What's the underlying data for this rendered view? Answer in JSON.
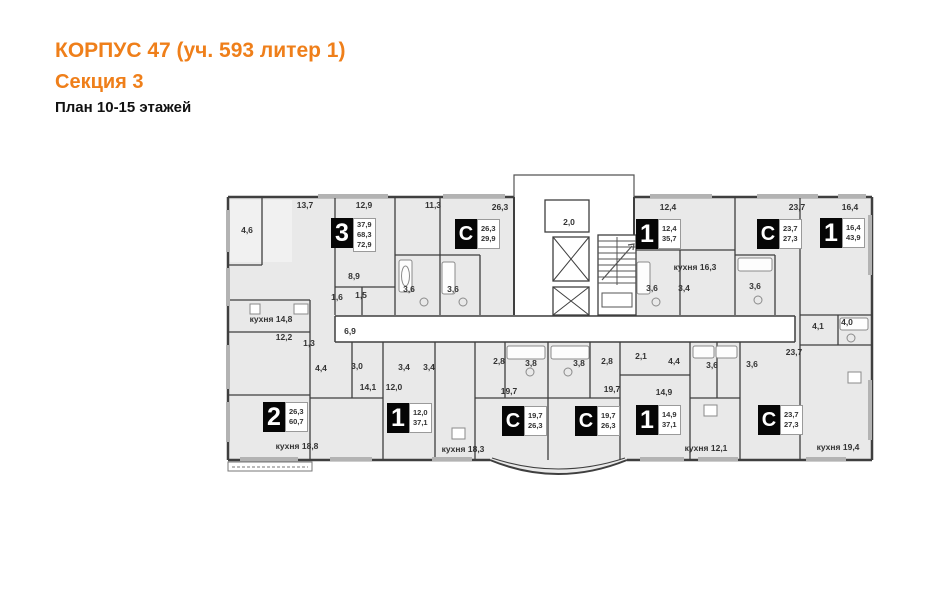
{
  "header": {
    "title": "КОРПУС 47 (уч. 593 литер 1)",
    "subtitle": "Секция 3",
    "plan_label": "План 10-15 этажей"
  },
  "colors": {
    "accent": "#EF7F1A",
    "wall": "#3f3f3f",
    "room_fill": "#e9e9e9"
  },
  "apartments": [
    {
      "type": "3",
      "areas": [
        "37,9",
        "68,3",
        "72,9"
      ]
    },
    {
      "type": "С",
      "areas": [
        "26,3",
        "29,9"
      ]
    },
    {
      "type": "1",
      "areas": [
        "12,4",
        "35,7"
      ]
    },
    {
      "type": "С",
      "areas": [
        "23,7",
        "27,3"
      ]
    },
    {
      "type": "1",
      "areas": [
        "16,4",
        "43,9"
      ]
    },
    {
      "type": "2",
      "areas": [
        "26,3",
        "60,7"
      ]
    },
    {
      "type": "1",
      "areas": [
        "12,0",
        "37,1"
      ]
    },
    {
      "type": "С",
      "areas": [
        "19,7",
        "26,3"
      ]
    },
    {
      "type": "С",
      "areas": [
        "19,7",
        "26,3"
      ]
    },
    {
      "type": "1",
      "areas": [
        "14,9",
        "37,1"
      ]
    },
    {
      "type": "С",
      "areas": [
        "23,7",
        "27,3"
      ]
    }
  ],
  "labels": [
    "4,6",
    "13,7",
    "12,9",
    "11,3",
    "26,3",
    "2,0",
    "12,4",
    "23,7",
    "16,4",
    "кухня 16,3",
    "8,9",
    "1,6",
    "1,5",
    "3,6",
    "3,6",
    "3,6",
    "3,4",
    "3,6",
    "4,1",
    "4,0",
    "кухня 14,8",
    "12,2",
    "1,3",
    "6,9",
    "4,4",
    "3,0",
    "14,1",
    "12,0",
    "3,4",
    "3,4",
    "кухня 18,8",
    "кухня 18,3",
    "2,8",
    "3,8",
    "3,8",
    "2,8",
    "19,7",
    "19,7",
    "2,1",
    "4,4",
    "3,6",
    "3,6",
    "14,9",
    "23,7",
    "кухня 12,1",
    "кухня 19,4"
  ]
}
